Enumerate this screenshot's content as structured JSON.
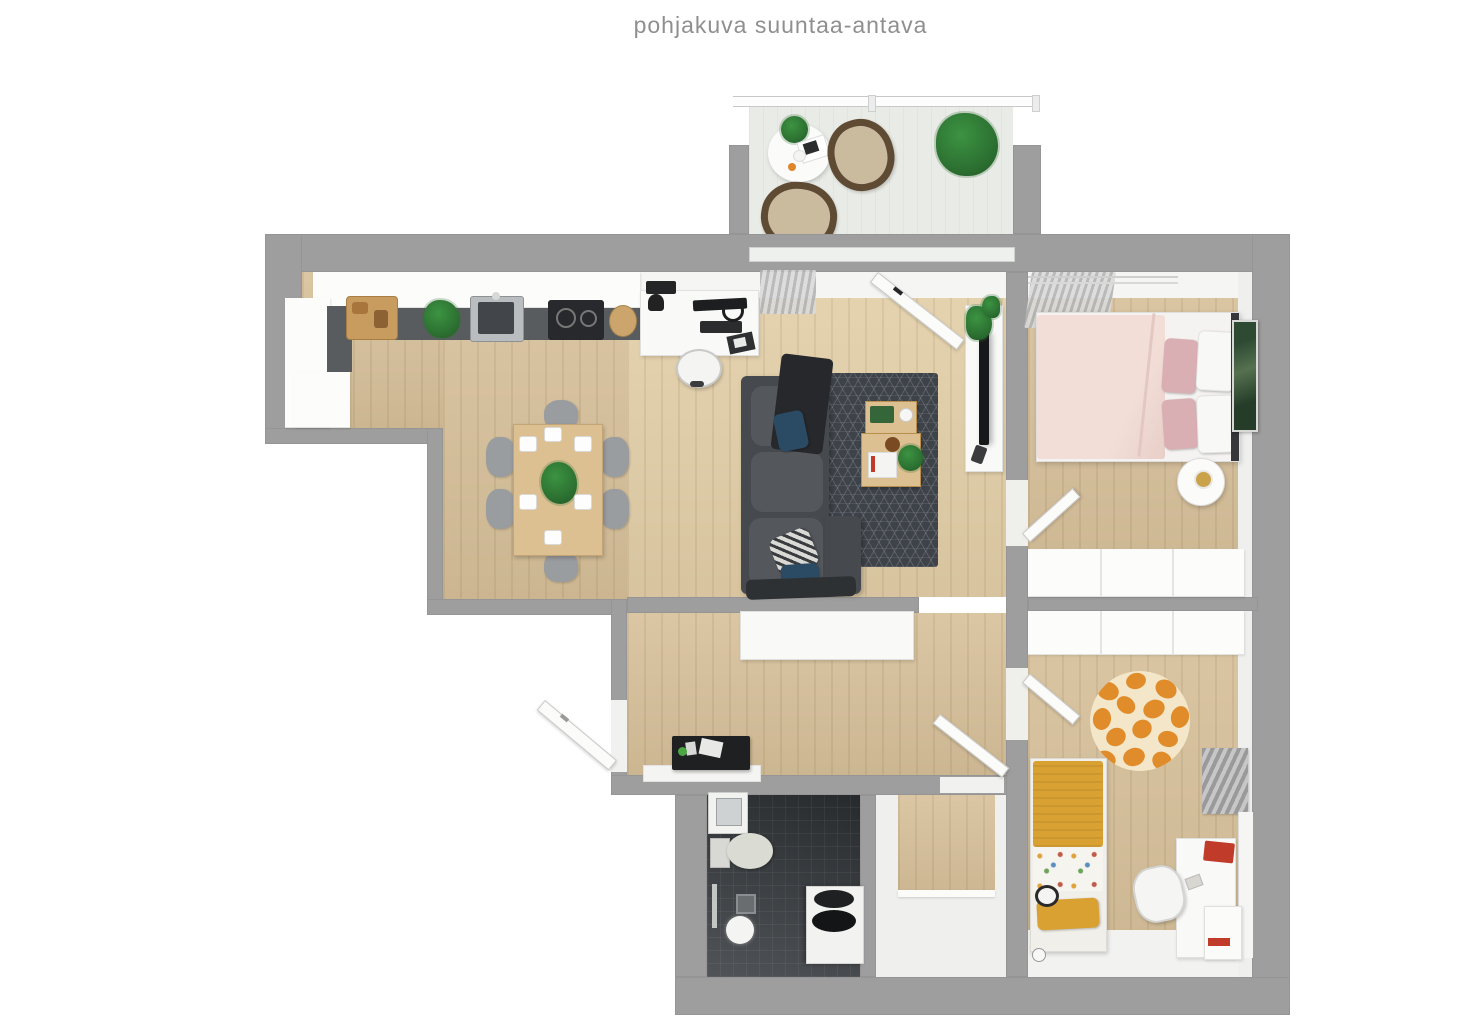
{
  "title": "pohjakuva suuntaa-antava",
  "palette": {
    "title_gray": "#8f8f8f",
    "wall": "#9e9e9e",
    "wood": "#d7c09a",
    "wood_light": "#e3cfa8",
    "balcony": "#e9ebe6",
    "bath_dark": "#34383c",
    "rug": "#3e434a",
    "sofa": "#46494d",
    "sofa_cushion": "#54575b",
    "navy": "#2b4a63",
    "mustard": "#d9a032",
    "blush": "#f2ddd7",
    "pink": "#d9afb3",
    "giraffe": "#e08c2b",
    "giraffe_base": "#f4e6c8",
    "green": "#3c9342",
    "counter_dark": "#595c5f",
    "table_wood": "#ddc091",
    "chair_gray": "#9a9da0",
    "red": "#c03b2a",
    "tv_black": "#17181a"
  }
}
